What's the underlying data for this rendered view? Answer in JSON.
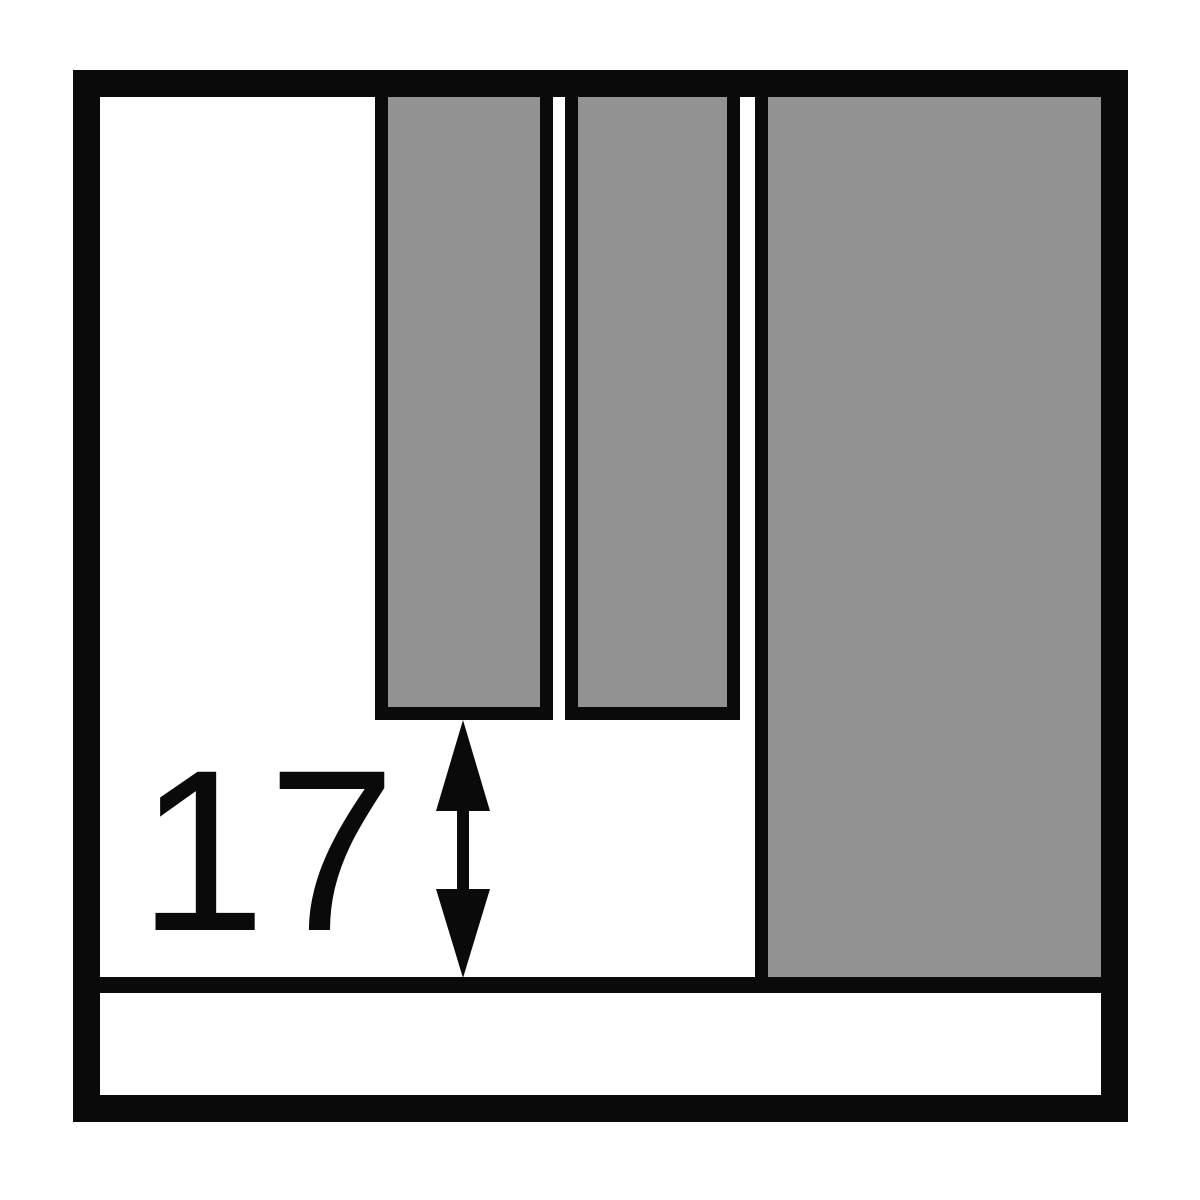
{
  "dimension": {
    "label": "17"
  },
  "icons": {
    "arrow": "vertical-double-headed-dimension-arrow"
  },
  "colors": {
    "background": "#ffffff",
    "line_black": "#0a0a0a",
    "fill_gray": "#929292"
  }
}
